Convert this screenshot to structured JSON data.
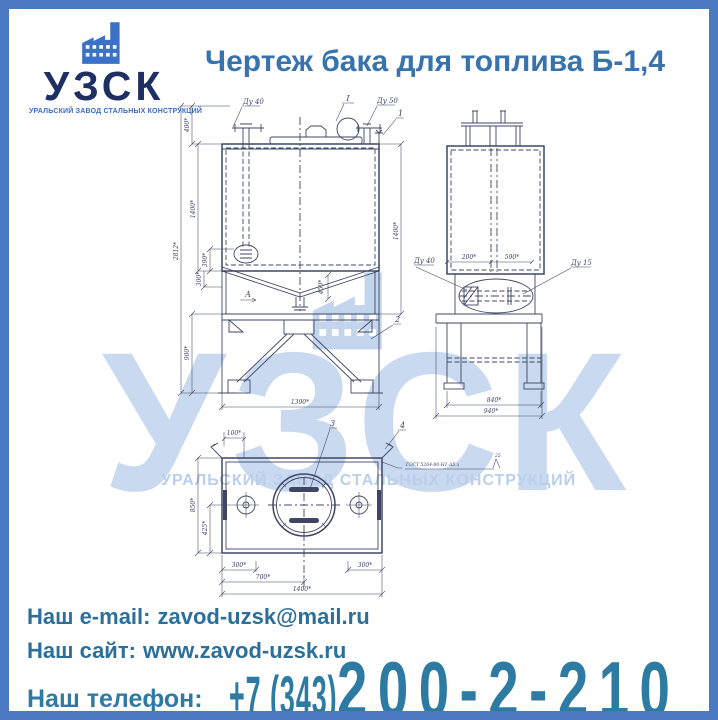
{
  "page": {
    "title": "Чертеж бака для топлива Б-1,4"
  },
  "logo": {
    "name": "УЗСК",
    "subtitle": "УРАЛЬСКИЙ ЗАВОД СТАЛЬНЫХ КОНСТРУКЦИЙ"
  },
  "watermark": {
    "name": "УЗСК",
    "subtitle": "УРАЛЬСКИЙ ЗАВОД СТАЛЬНЫХ КОНСТРУКЦИЙ"
  },
  "drawing": {
    "front_view": {
      "fitting_left_label": "Ду 40",
      "view_mark": "I",
      "fitting_right_label": "Ду 50",
      "callout_top": "1",
      "callout_support": "2",
      "section_mark": "А",
      "dim_top_height": "400*",
      "dim_tank_height_left": "1400*",
      "dim_overall_height": "2812*",
      "dim_drain_390": "390*",
      "dim_drain_300": "300*",
      "dim_support_height": "900*",
      "dim_tank_height_right": "1400*",
      "dim_width": "1390*",
      "dim_funnel": "450*"
    },
    "side_view": {
      "dim_200": "200*",
      "dim_590": "590*",
      "dim_840": "840*",
      "dim_940": "940*",
      "detail_left_label": "Ду 40",
      "detail_right_label": "Ду 15"
    },
    "plan_view": {
      "callout_manhole": "3",
      "callout_corner": "4",
      "dim_100": "100*",
      "dim_850": "850*",
      "dim_425": "425*",
      "dim_300_left": "300*",
      "dim_300_right": "300*",
      "dim_700": "700*",
      "dim_1400": "1400*",
      "weld_note": "ГОСТ 5264-80-Н1-Δ5 з",
      "weld_flag": "25"
    }
  },
  "contacts": {
    "email_label": "Наш e-mail:",
    "email_value": "zavod-uzsk@mail.ru",
    "site_label": "Наш сайт:",
    "site_value": "www.zavod-uzsk.ru",
    "phone_label": "Наш телефон:",
    "phone_code": "+7 (343)",
    "phone_number": "200-2-210"
  },
  "colors": {
    "border": "#4a79c1",
    "title": "#3873ae",
    "logo_navy": "#1d2f63",
    "logo_blue": "#3b72c7",
    "contact_text": "#2b6f9a",
    "phone_text": "#2d7ba3",
    "watermark": "#c9d9ef",
    "drawing_line": "#3f4663"
  }
}
